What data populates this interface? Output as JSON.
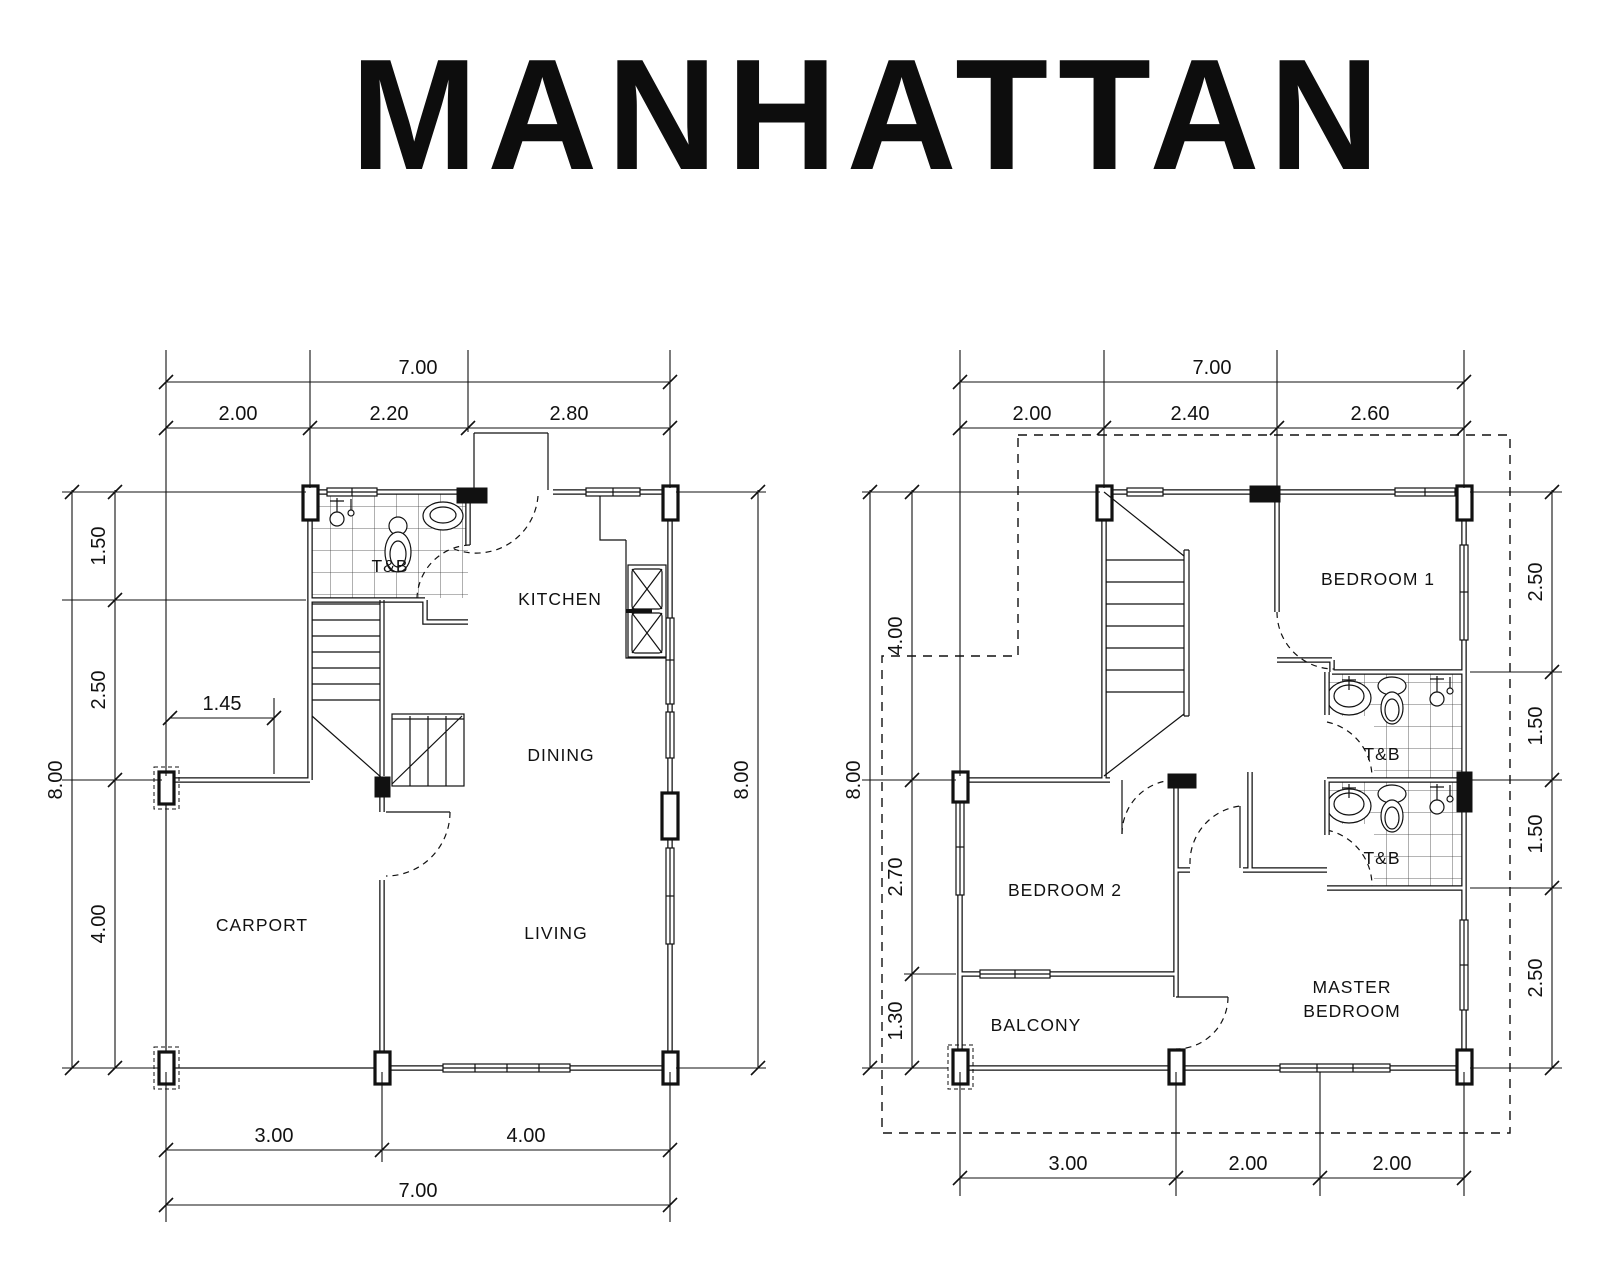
{
  "title": "MANHATTAN",
  "ink": "#111111",
  "ground_floor": {
    "rooms": {
      "tb": "T&B",
      "kitchen": "KITCHEN",
      "dining": "DINING",
      "living": "LIVING",
      "carport": "CARPORT"
    },
    "dims": {
      "top_total": "7.00",
      "top": [
        "2.00",
        "2.20",
        "2.80"
      ],
      "left_total": "8.00",
      "left": [
        "1.50",
        "2.50",
        "4.00"
      ],
      "inner": "1.45",
      "right_total": "8.00",
      "bottom": [
        "3.00",
        "4.00"
      ],
      "bottom_total": "7.00"
    }
  },
  "second_floor": {
    "rooms": {
      "bedroom1": "BEDROOM 1",
      "tb1": "T&B",
      "tb2": "T&B",
      "bedroom2": "BEDROOM 2",
      "balcony": "BALCONY",
      "master": [
        "MASTER",
        "BEDROOM"
      ]
    },
    "dims": {
      "top_total": "7.00",
      "top": [
        "2.00",
        "2.40",
        "2.60"
      ],
      "left_total": "8.00",
      "left": [
        "4.00",
        "2.70",
        "1.30"
      ],
      "right": [
        "2.50",
        "1.50",
        "1.50",
        "2.50"
      ],
      "bottom": [
        "3.00",
        "2.00",
        "2.00"
      ]
    }
  }
}
